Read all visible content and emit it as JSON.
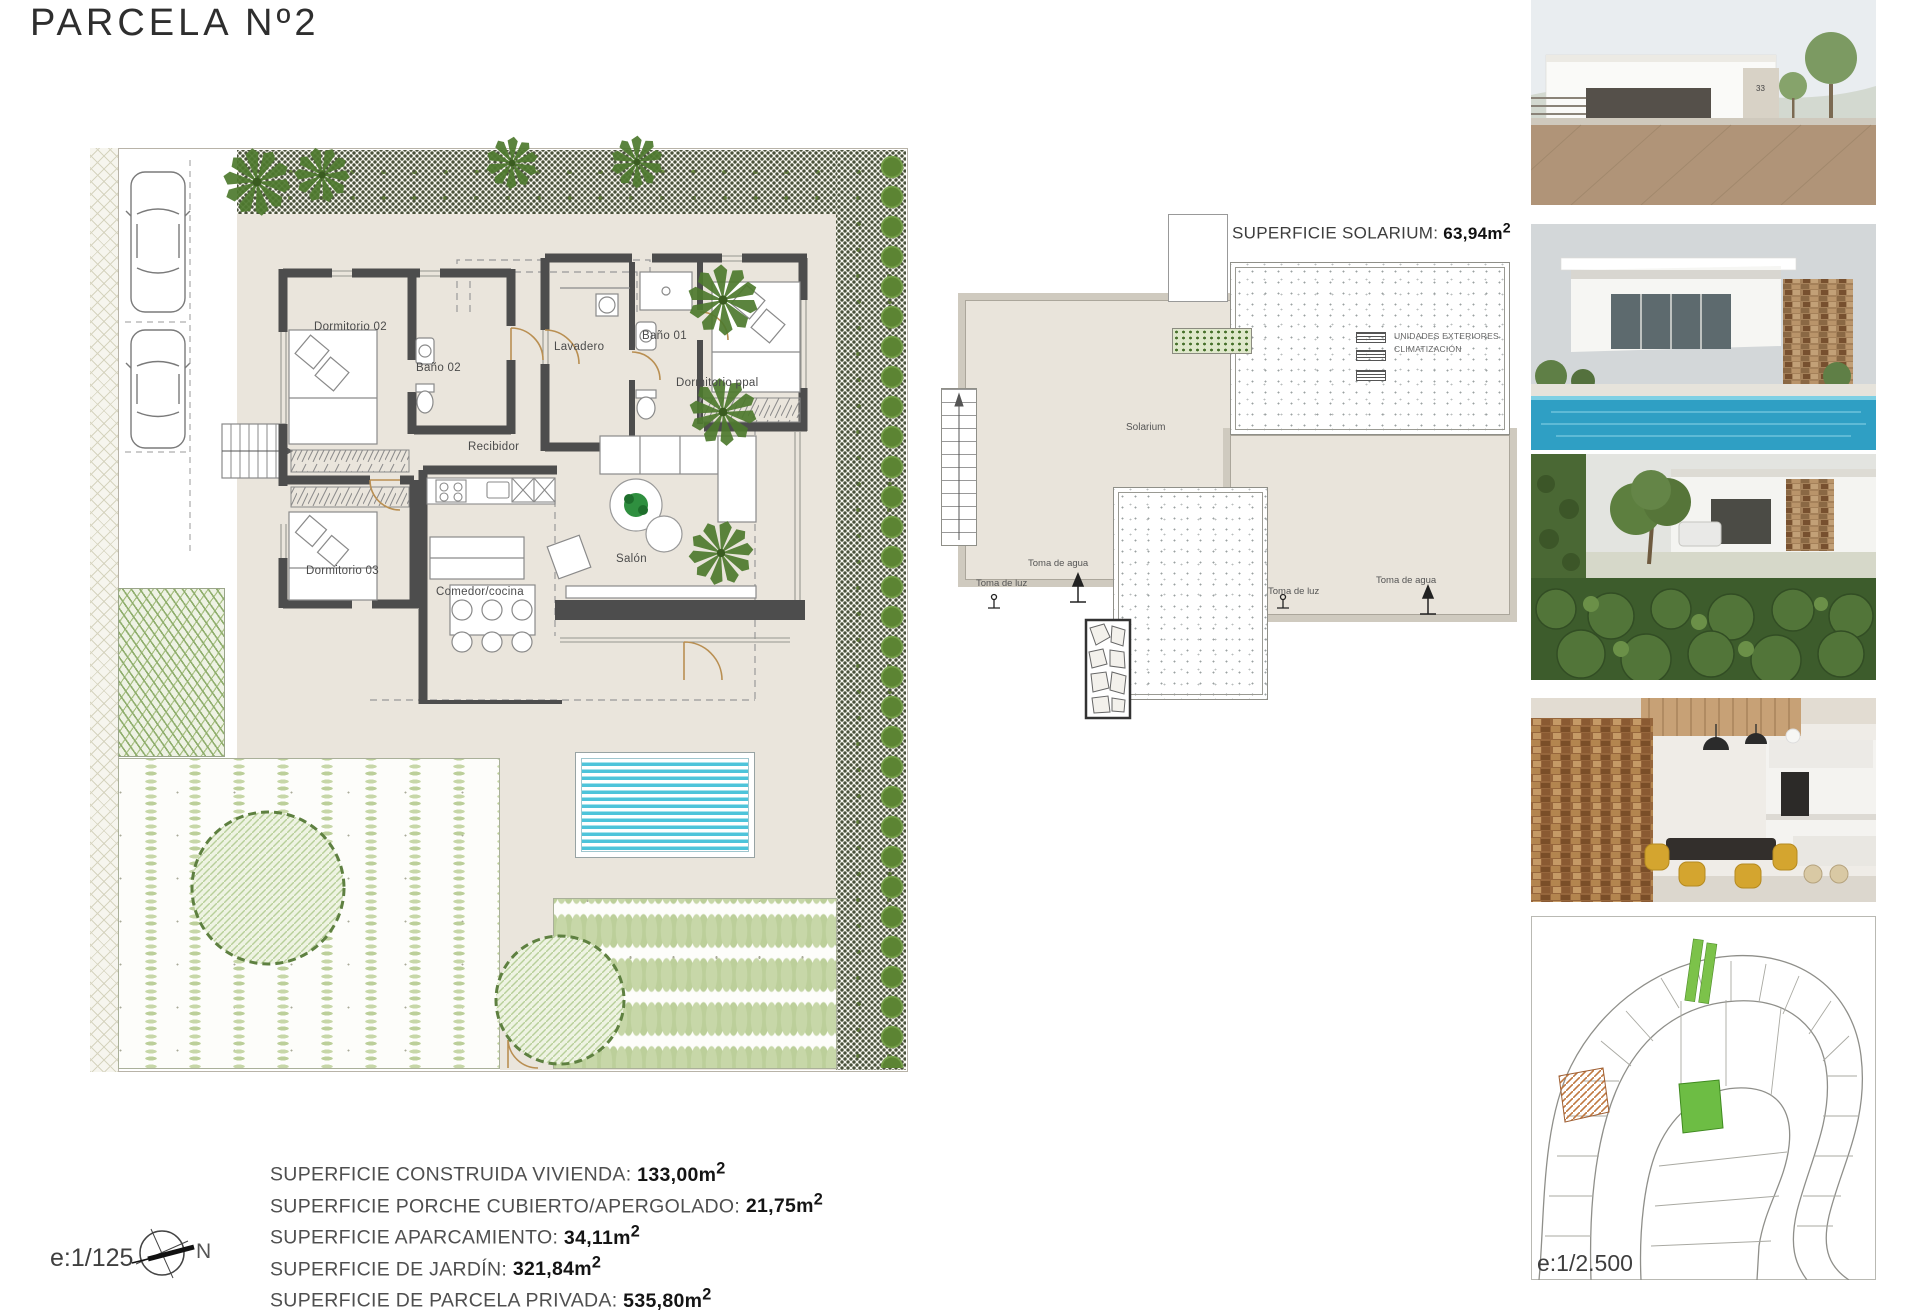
{
  "title": "PARCELA Nº2",
  "floor_plan": {
    "rooms": {
      "dormitorio02": "Dormitorio 02",
      "bano02": "Baño 02",
      "lavadero": "Lavadero",
      "bano01": "Baño 01",
      "dormitorio_ppal": "Dormitorio ppal",
      "recibidor": "Recibidor",
      "dormitorio03": "Dormitorio 03",
      "salon": "Salón",
      "comedor_cocina": "Comedor/cocina"
    }
  },
  "solarium": {
    "title_label": "SUPERFICIE SOLARIUM: ",
    "title_value": "63,94m",
    "title_sup": "2",
    "room_label": "Solarium",
    "ac_label_line1": "UNIDADES EXTERIORES",
    "ac_label_line2": "CLIMATIZACIÓN",
    "toma_luz": "Toma de luz",
    "toma_agua": "Toma de agua"
  },
  "summary": {
    "rows": [
      {
        "label": "SUPERFICIE CONSTRUIDA VIVIENDA: ",
        "value": "133,00m",
        "sup": "2"
      },
      {
        "label": "SUPERFICIE PORCHE CUBIERTO/APERGOLADO: ",
        "value": "21,75m",
        "sup": "2"
      },
      {
        "label": "SUPERFICIE APARCAMIENTO: ",
        "value": "34,11m",
        "sup": "2"
      },
      {
        "label": "SUPERFICIE DE JARDÍN: ",
        "value": "321,84m",
        "sup": "2"
      },
      {
        "label": "SUPERFICIE DE PARCELA PRIVADA: ",
        "value": "535,80m",
        "sup": "2"
      }
    ]
  },
  "scale_plan": "e:1/125",
  "scale_map": "e:1/2.500",
  "compass_north": "N",
  "photos": {
    "house_number": "33",
    "items": [
      {
        "name": "photo-villa-street-view"
      },
      {
        "name": "photo-villa-pool-render"
      },
      {
        "name": "photo-villa-garden-render"
      },
      {
        "name": "photo-villa-interior-render"
      },
      {
        "name": "site-location-map"
      }
    ]
  },
  "colors": {
    "terrace_beige": "#eae5dc",
    "wall_gray": "#4d4d4d",
    "pool_blue": "#4ec4da",
    "garden_row_green": "#c7d7a8",
    "bush_green": "#5c8433",
    "map_parcel_green": "#6dbd44",
    "map_parcel_orange": "#c07840"
  }
}
